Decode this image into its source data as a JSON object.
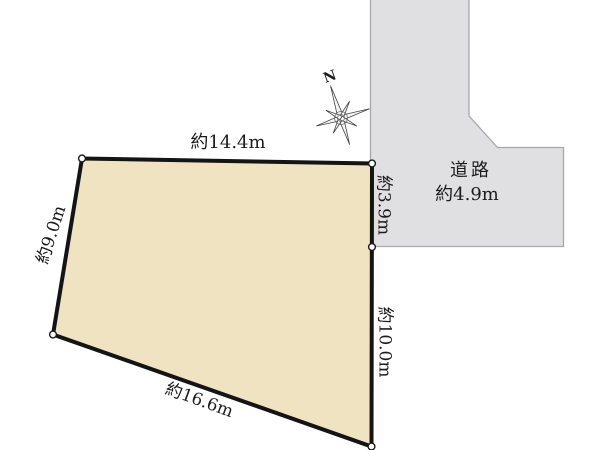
{
  "plot": {
    "edge_labels": {
      "top": "約14.4m",
      "left": "約9.0m",
      "right_upper": "約3.9m",
      "right_lower": "約10.0m",
      "bottom": "約16.6m"
    }
  },
  "road": {
    "name": "道路",
    "width": "約4.9m"
  },
  "compass": {
    "north_label": "N"
  },
  "colors": {
    "plot_fill": "#f0e3c2",
    "plot_outline": "#141414",
    "road_fill": "#e0e0e2",
    "road_outline": "#a8a8ac",
    "text": "#1c1c1c"
  }
}
